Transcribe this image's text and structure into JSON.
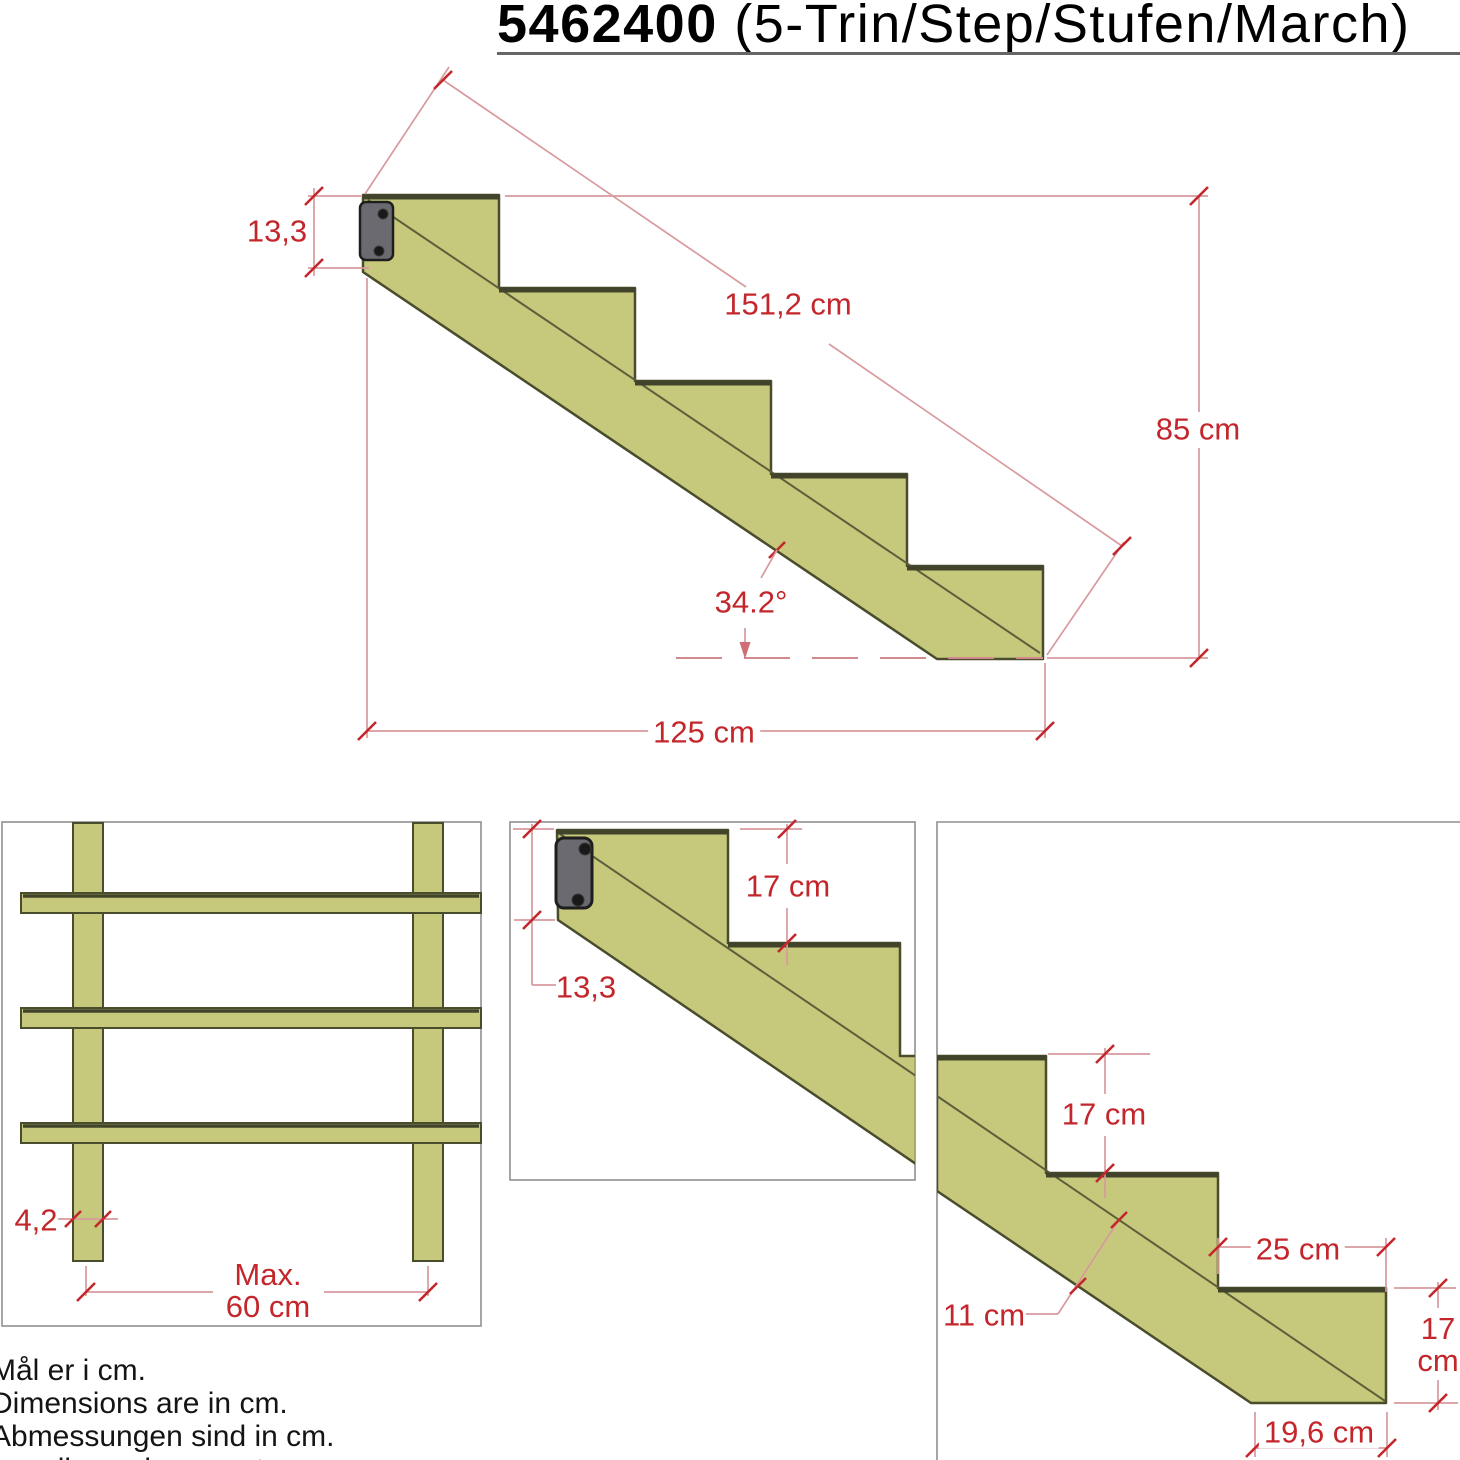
{
  "title": {
    "part_number": "5462400",
    "suffix": " (5-Trin/Step/Stufen/March)"
  },
  "main_view": {
    "description": "side-elevation-5-step-stringer",
    "dims": {
      "stringer_top_width": "13,3",
      "stringer_length": "151,2 cm",
      "total_height": "85 cm",
      "angle": "34.2°",
      "total_run": "125 cm"
    }
  },
  "front_view": {
    "description": "front-view-treads-on-two-stringers",
    "dims": {
      "stringer_thickness": "4,2",
      "max_spacing_line1": "Max.",
      "max_spacing_line2": "60 cm"
    }
  },
  "top_detail_view": {
    "description": "detail-top-of-stringer-with-bracket",
    "dims": {
      "riser_height": "17 cm",
      "stringer_top_width": "13,3"
    }
  },
  "step_detail_view": {
    "description": "detail-bottom-steps",
    "dims": {
      "riser_height": "17 cm",
      "tread_run": "25 cm",
      "stringer_depth": "11 cm",
      "right_riser_value": "17",
      "right_riser_unit": "cm",
      "bottom_length": "19,6 cm"
    }
  },
  "notes": [
    "Mål er i cm.",
    "Dimensions are in cm.",
    "Abmessungen sind in cm.",
    "Les dimensions sont en cm."
  ],
  "colors": {
    "wood_fill": "#c6c87c",
    "wood_outline": "#4a4d2c",
    "tread_edge": "#41442a",
    "bracket_fill": "#6b6a70",
    "dimension_text": "#c3262b",
    "dimension_line": "#d89a9e",
    "box_border": "#8f8f8f"
  }
}
